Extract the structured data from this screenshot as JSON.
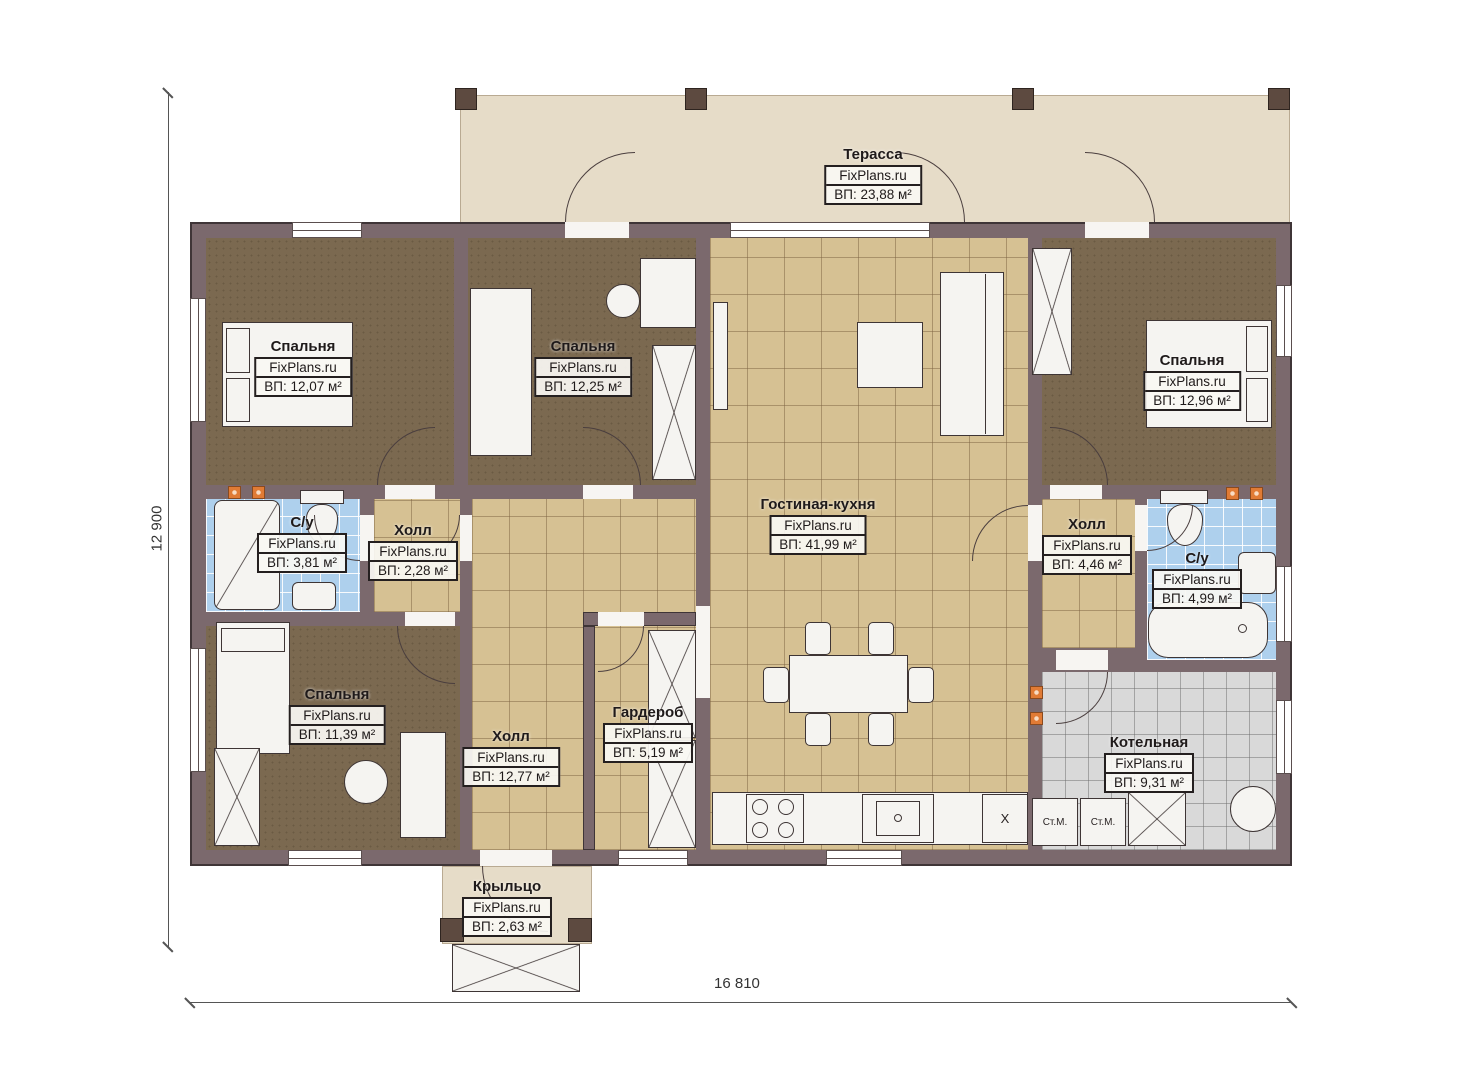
{
  "plan": {
    "brand": "FixPlans.ru",
    "dimensions": {
      "vertical": "12 900",
      "horizontal": "16 810"
    },
    "rooms": [
      {
        "key": "terrace",
        "name": "Терасса",
        "brand": "FixPlans.ru",
        "area": "ВП: 23,88 м²"
      },
      {
        "key": "bedroom-top-left",
        "name": "Спальня",
        "brand": "FixPlans.ru",
        "area": "ВП: 12,07 м²"
      },
      {
        "key": "bedroom-top-center",
        "name": "Спальня",
        "brand": "FixPlans.ru",
        "area": "ВП: 12,25 м²"
      },
      {
        "key": "bedroom-top-right",
        "name": "Спальня",
        "brand": "FixPlans.ru",
        "area": "ВП: 12,96 м²"
      },
      {
        "key": "bathroom-left",
        "name": "С/у",
        "brand": "FixPlans.ru",
        "area": "ВП: 3,81 м²"
      },
      {
        "key": "hall-small-left",
        "name": "Холл",
        "brand": "FixPlans.ru",
        "area": "ВП: 2,28 м²"
      },
      {
        "key": "living-kitchen",
        "name": "Гостиная-кухня",
        "brand": "FixPlans.ru",
        "area": "ВП: 41,99 м²"
      },
      {
        "key": "hall-right",
        "name": "Холл",
        "brand": "FixPlans.ru",
        "area": "ВП: 4,46 м²"
      },
      {
        "key": "bathroom-right",
        "name": "С/у",
        "brand": "FixPlans.ru",
        "area": "ВП: 4,99 м²"
      },
      {
        "key": "bedroom-bottom-left",
        "name": "Спальня",
        "brand": "FixPlans.ru",
        "area": "ВП: 11,39 м²"
      },
      {
        "key": "hall-main",
        "name": "Холл",
        "brand": "FixPlans.ru",
        "area": "ВП: 12,77 м²"
      },
      {
        "key": "wardrobe",
        "name": "Гардероб",
        "brand": "FixPlans.ru",
        "area": "ВП: 5,19 м²"
      },
      {
        "key": "boiler-room",
        "name": "Котельная",
        "brand": "FixPlans.ru",
        "area": "ВП: 9,31 м²"
      },
      {
        "key": "porch",
        "name": "Крыльцо",
        "brand": "FixPlans.ru",
        "area": "ВП: 2,63 м²"
      }
    ],
    "appliances": {
      "washer1": "Ст.М.",
      "washer2": "Ст.М.",
      "fridge": "X"
    },
    "colors": {
      "wall": "#7b696d",
      "carpet": "#7b6950",
      "tile_beige": "#d6c193",
      "tile_blue": "#aed0ed",
      "tile_gray": "#d9d9d9",
      "terrace": "#e6dcc8",
      "radiator": "#e07b35"
    }
  }
}
